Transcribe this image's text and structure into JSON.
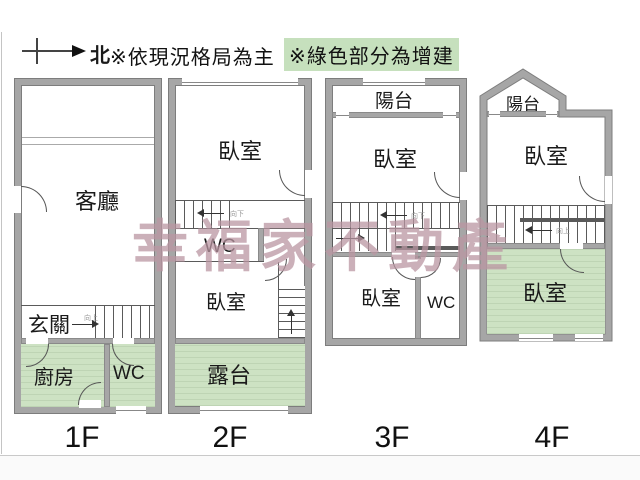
{
  "header": {
    "compass_label": "北",
    "note_primary": "※依現況格局為主",
    "note_addition": "※綠色部分為增建"
  },
  "watermark": {
    "text": "幸福家不動產",
    "color": "#bb96a1"
  },
  "colors": {
    "addition_green": "#cde2c3",
    "wall_gray": "#a6a6a6"
  },
  "annotations": {
    "up": "向上",
    "down": "向下"
  },
  "floors": {
    "f1": {
      "label": "1F",
      "living": "客廳",
      "foyer": "玄關",
      "kitchen": "廚房",
      "wc": "WC"
    },
    "f2": {
      "label": "2F",
      "bedroom_front": "臥室",
      "wc": "WC",
      "bedroom_rear": "臥室",
      "terrace": "露台"
    },
    "f3": {
      "label": "3F",
      "balcony": "陽台",
      "bedroom_front": "臥室",
      "bedroom_rear": "臥室",
      "wc": "WC"
    },
    "f4": {
      "label": "4F",
      "balcony": "陽台",
      "bedroom_front": "臥室",
      "bedroom_rear": "臥室"
    }
  }
}
